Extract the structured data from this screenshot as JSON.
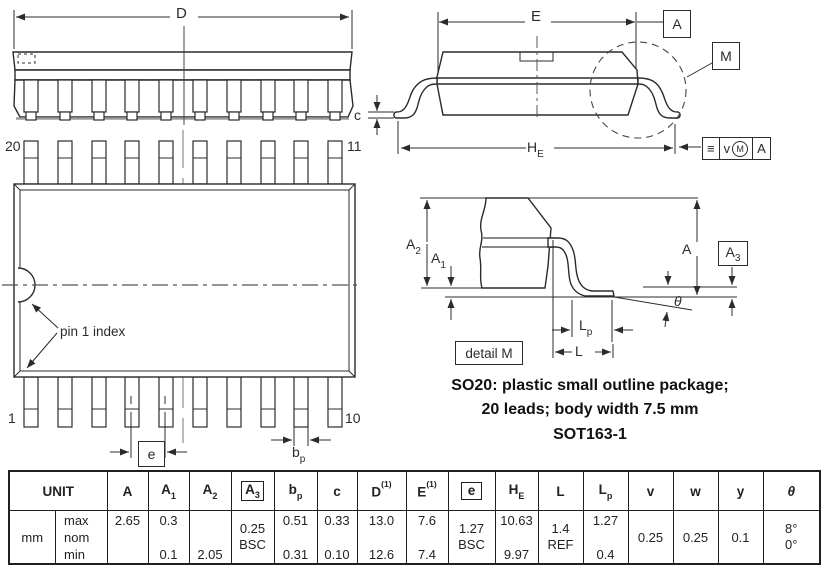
{
  "labels": {
    "d_dim": "D",
    "e_dim": "E",
    "c_dim": "c",
    "l_dim": "L",
    "a_dim": "A",
    "theta": "θ",
    "he_dim": {
      "base": "H",
      "sub": "E"
    },
    "a1": {
      "base": "A",
      "sub": "1"
    },
    "a2": {
      "base": "A",
      "sub": "2"
    },
    "a3": {
      "base": "A",
      "sub": "3"
    },
    "lp": {
      "base": "L",
      "sub": "p"
    },
    "bp": {
      "base": "b",
      "sub": "p"
    },
    "e_pitch": "e",
    "datum_a": "A",
    "detail_m_ref": "M",
    "detail_m_label": "detail M",
    "pin1_index": "pin 1 index",
    "pin_20": "20",
    "pin_11": "11",
    "pin_1": "1",
    "pin_10": "10",
    "fcf": {
      "symbol": "≡",
      "value": "v",
      "modifier": "M",
      "datum": "A"
    }
  },
  "title": {
    "line1": "SO20: plastic small outline package;",
    "line2": "20 leads; body width 7.5 mm",
    "line3": "SOT163-1"
  },
  "table": {
    "unit_label": "UNIT",
    "unit_value": "mm",
    "row_labels": {
      "max": "max",
      "nom": "nom",
      "min": "min"
    },
    "headers": [
      {
        "base": "A"
      },
      {
        "base": "A",
        "sub": "1"
      },
      {
        "base": "A",
        "sub": "2"
      },
      {
        "base": "A",
        "sub": "3"
      },
      {
        "base": "b",
        "sub": "p"
      },
      {
        "base": "c"
      },
      {
        "base": "D",
        "sup": "(1)"
      },
      {
        "base": "E",
        "sup": "(1)"
      },
      {
        "base": "e"
      },
      {
        "base": "H",
        "sub": "E"
      },
      {
        "base": "L"
      },
      {
        "base": "L",
        "sub": "p"
      },
      {
        "base": "v"
      },
      {
        "base": "w"
      },
      {
        "base": "y"
      },
      {
        "base": "θ"
      }
    ],
    "cols": {
      "A": {
        "max": "2.65"
      },
      "A1": {
        "max": "0.3",
        "min": "0.1"
      },
      "A2": {
        "min": "2.05"
      },
      "A3": {
        "l1": "0.25",
        "l2": "BSC"
      },
      "bp": {
        "max": "0.51",
        "min": "0.31"
      },
      "c": {
        "max": "0.33",
        "min": "0.10"
      },
      "D": {
        "max": "13.0",
        "min": "12.6"
      },
      "E": {
        "max": "7.6",
        "min": "7.4"
      },
      "e": {
        "l1": "1.27",
        "l2": "BSC"
      },
      "HE": {
        "max": "10.63",
        "min": "9.97"
      },
      "L": {
        "l1": "1.4",
        "l2": "REF"
      },
      "Lp": {
        "max": "1.27",
        "min": "0.4"
      },
      "v": {
        "mid": "0.25"
      },
      "w": {
        "mid": "0.25"
      },
      "y": {
        "mid": "0.1"
      },
      "theta": {
        "l1": "8°",
        "l2": "0°"
      }
    }
  }
}
